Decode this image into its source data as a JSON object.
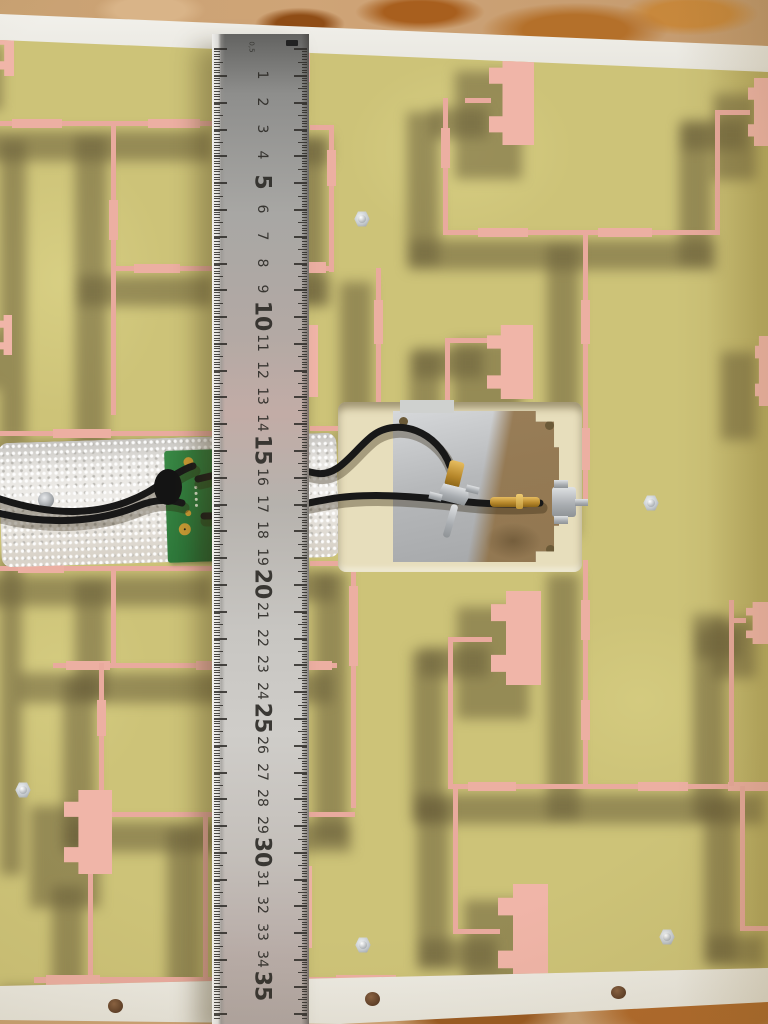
{
  "ruler": {
    "unit_label": "0,5",
    "numbers": [
      1,
      2,
      3,
      4,
      5,
      6,
      7,
      8,
      9,
      10,
      11,
      12,
      13,
      14,
      15,
      16,
      17,
      18,
      19,
      20,
      21,
      22,
      23,
      24,
      25,
      26,
      27,
      28,
      29,
      30,
      31,
      32,
      33,
      34,
      35
    ],
    "major_interval": 5
  },
  "objects": {
    "carpet": "carpet-background",
    "frame": "white-panel-frame",
    "board": "antenna-pcb",
    "traces": "copper-feed-network",
    "patches": "antenna-patches",
    "ruler": "steel-ruler",
    "foam": "foam-backing",
    "green_module": "green-pcb-module",
    "plate": "metal-shield-plate",
    "cables": "coaxial-cables",
    "connectors": "sma-connectors",
    "screws": "mounting-screws"
  },
  "colors": {
    "carpet": "#c99d6d",
    "carpet_rust": "#a86226",
    "frame": "#eae8e1",
    "pcb": "#cdc378",
    "pcb_light": "#dcd489",
    "trace": "#e9aa9e",
    "patch": "#f0b5a8",
    "shadow": "#6a5e3c",
    "ruler_face": "#aaa8a4",
    "tick": "#2e2c28",
    "foam": "#e3e1dd",
    "green": "#2e7a3a",
    "gold": "#c89a34",
    "cable": "#1a1a1a",
    "plate_silver": "#c6c8ca",
    "plate_bronze": "#8f6f42",
    "cream": "#e7debc",
    "screw": "#d2d6d8"
  }
}
